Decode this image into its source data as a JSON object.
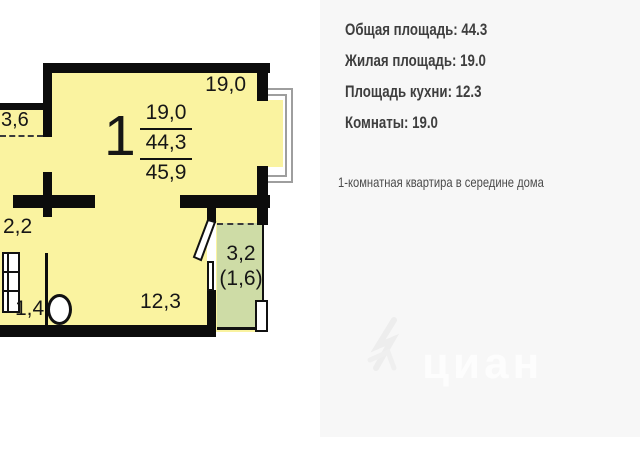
{
  "colors": {
    "room_fill": "#FAF3A0",
    "balcony_fill": "#CEDCA6",
    "wall": "#0C0C0C",
    "panel_background": "#F7F7F7",
    "panel_text": "#3E3E3E",
    "plan_text": "#161616"
  },
  "floor_plan": {
    "room_number": "1",
    "area_stack": {
      "living": "19,0",
      "total": "44,3",
      "total_with_balcony": "45,9"
    },
    "room_labels": {
      "living_area": "19,0",
      "left_balcony": "3,6",
      "bathroom": "2,2",
      "wc": "1,4",
      "kitchen": "12,3",
      "balcony_area": "3,2",
      "balcony_reduced": "(1,6)"
    }
  },
  "info_panel": {
    "stats": [
      "Общая площадь: 44.3",
      "Жилая площадь: 19.0",
      "Площадь кухни: 12.3",
      "Комнаты: 19.0"
    ],
    "description": "1-комнатная квартира в середине дома",
    "watermark": "циан"
  }
}
